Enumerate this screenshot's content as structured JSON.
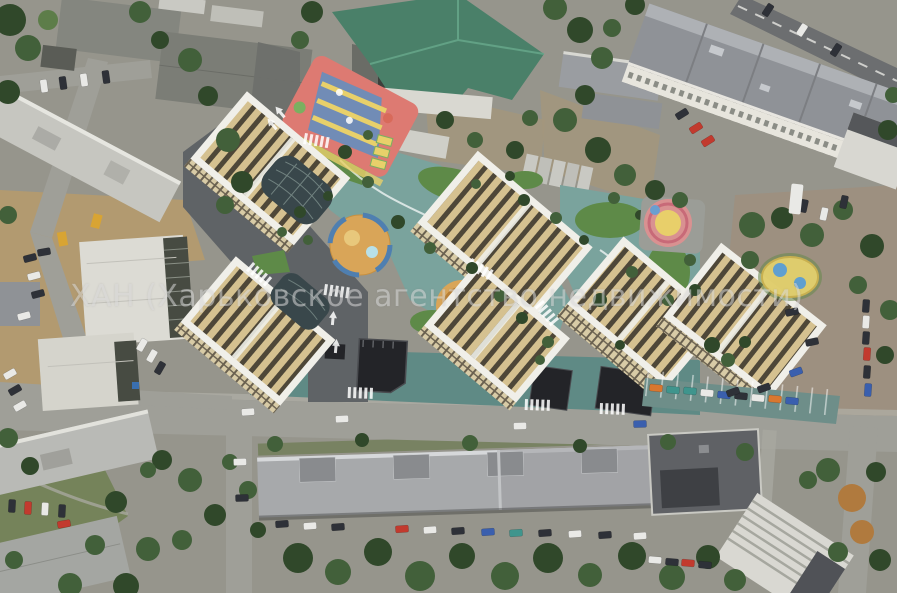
{
  "watermark": {
    "text": "ХАН (Харьковское агентство недвижимости)"
  },
  "colors": {
    "asphalt": "#96958c",
    "roadDark": "#6c6e70",
    "dirt": "#9d9080",
    "construction": "#b29a70",
    "tree": "#42603a",
    "treeDark": "#30482a",
    "treeLight": "#5d7d49",
    "autumn": "#b07a3e",
    "greenRoof": "#4a8069",
    "greenRoofDark": "#2f5d4a",
    "slabGray": "#8f9297",
    "white": "#f0efe9",
    "cream": "#d5c190",
    "stripeDark": "#4e4738",
    "glass": "#39474b",
    "blackRoof": "#232428",
    "teal": "#7aa39d",
    "tealDark": "#5f8a85",
    "renderRoad": "#5f6366",
    "lawn": "#5e8a48",
    "sand": "#d9a558",
    "pool": "#4f7fb0",
    "playPink": "#dd7a72",
    "playBlue": "#5e8fc2",
    "playYellow": "#e8d06a",
    "playGreen": "#7ab060",
    "carWhite": "#e9e9e6",
    "carDark": "#2e3138",
    "carRed": "#c23a2e",
    "carBlue": "#3a5fae",
    "carTeal": "#3f958d",
    "carOrange": "#d9772f",
    "watermark": "#d7d7d7"
  }
}
